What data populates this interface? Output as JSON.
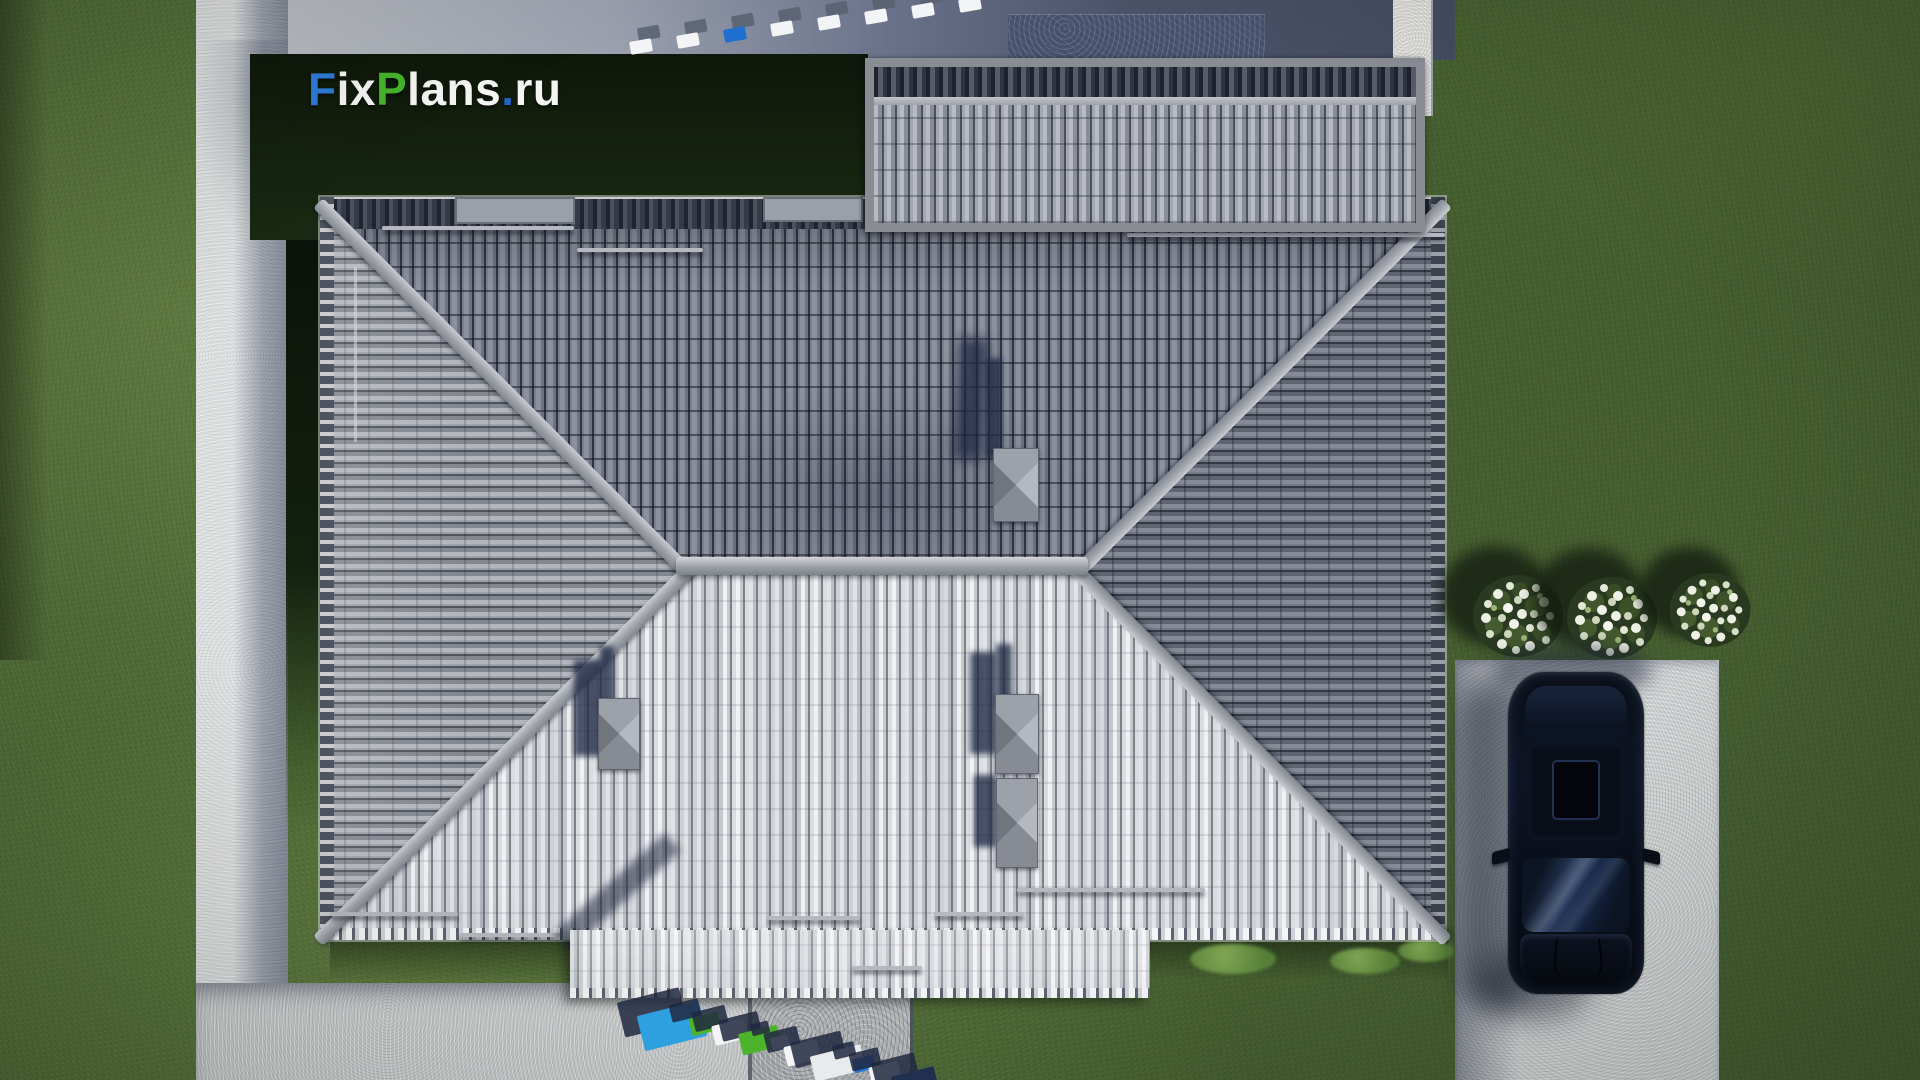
{
  "scene": {
    "type": "3d-aerial-architectural-render",
    "description": "Top-down aerial render of a hip-roof house with concrete paths, driveway, parked car, lawn and flower bushes",
    "watermark": {
      "text": "FixPlans.ru",
      "parts": [
        {
          "t": "F",
          "c": "#2e7cd9"
        },
        {
          "t": "ix",
          "c": "#f4f5f3"
        },
        {
          "t": "P",
          "c": "#45b42c"
        },
        {
          "t": "lans",
          "c": "#f4f5f3"
        },
        {
          "t": ".",
          "c": "#2563c9"
        },
        {
          "t": "ru",
          "c": "#f4f5f3"
        }
      ]
    },
    "palette": {
      "grass": "#536f3a",
      "grass_shaded": "#466032",
      "dark_ground": "#15220f",
      "concrete_path": "#cdcfd0",
      "driveway": "#cfd1d3",
      "roof_north_slope": "#747986",
      "roof_south_slope": "#d6d8dc",
      "roof_west_slope": "#94989f",
      "roof_east_slope": "#6b707d",
      "ridge_cap": "#b9bcc2",
      "chimney_cap": "#989ca4",
      "shadow_navy": "#1f2844",
      "car_body": "#0b1120",
      "flowers": "#eef0e6"
    },
    "objects": {
      "cars": 1,
      "flower_bushes": 3,
      "chimneys": 4,
      "roof_vents": 2,
      "roof_slopes": 4,
      "secondary_roofs": 1
    }
  },
  "top_marker_blocks": [
    "#f2f4f6",
    "#f2f4f6",
    "#1e6fd0",
    "#f2f4f6",
    "#f2f4f6",
    "#f2f4f6",
    "#f2f4f6",
    "#f2f4f6"
  ],
  "bottom_marker_blocks": [
    "#2ea0e0",
    "#4db32a",
    "#f4f5f7",
    "#4db32a",
    "#eef0f3",
    "#f4f5f7",
    "#e8ebee",
    "#2b76d8",
    "#f4f5f7",
    "#223050"
  ]
}
